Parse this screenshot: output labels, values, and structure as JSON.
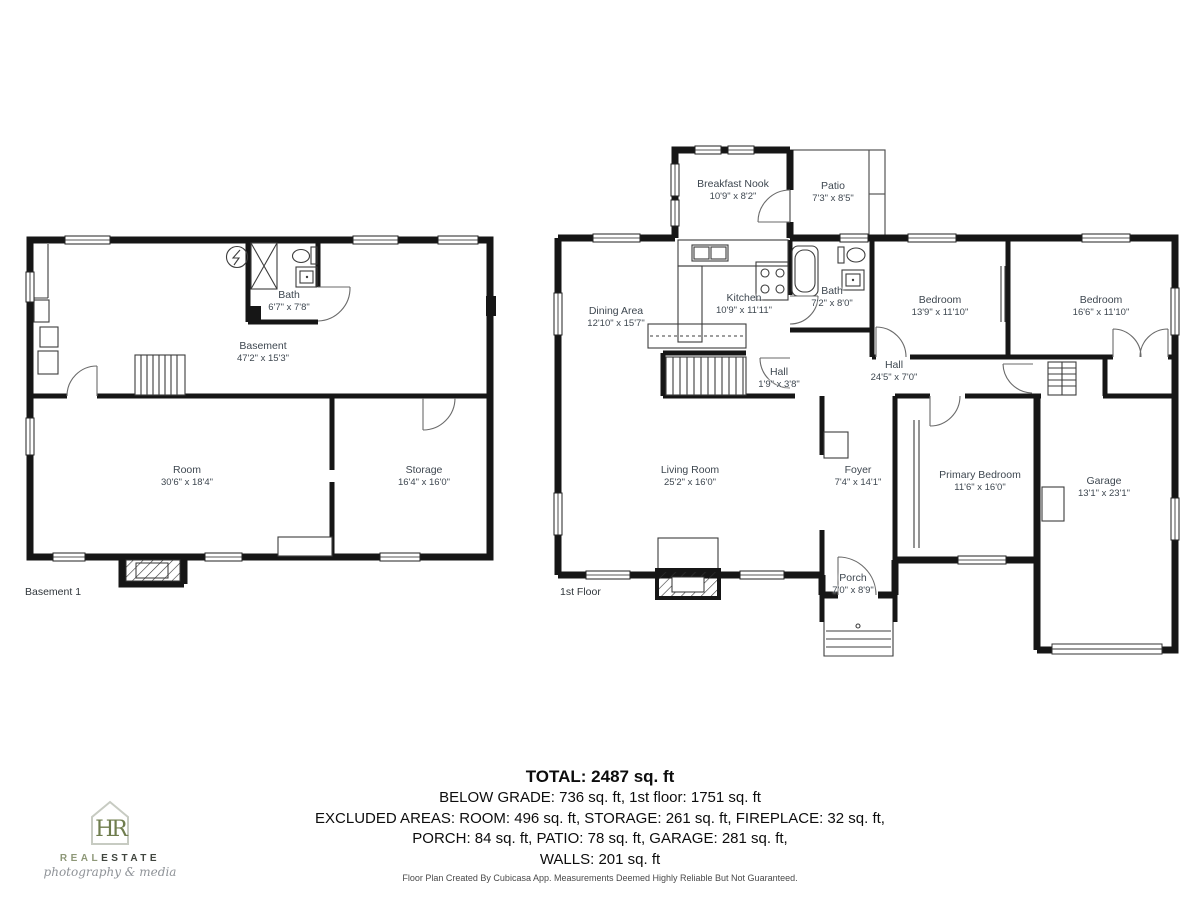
{
  "floors": {
    "basement": {
      "label": "Basement 1",
      "rooms": {
        "bath": {
          "name": "Bath",
          "dims": "6'7\" x 7'8\""
        },
        "basement": {
          "name": "Basement",
          "dims": "47'2\" x 15'3\""
        },
        "room": {
          "name": "Room",
          "dims": "30'6\" x 18'4\""
        },
        "storage": {
          "name": "Storage",
          "dims": "16'4\" x 16'0\""
        }
      }
    },
    "first": {
      "label": "1st Floor",
      "rooms": {
        "breakfast_nook": {
          "name": "Breakfast Nook",
          "dims": "10'9\" x 8'2\""
        },
        "patio": {
          "name": "Patio",
          "dims": "7'3\" x 8'5\""
        },
        "dining": {
          "name": "Dining Area",
          "dims": "12'10\" x 15'7\""
        },
        "kitchen": {
          "name": "Kitchen",
          "dims": "10'9\" x 11'11\""
        },
        "bath": {
          "name": "Bath",
          "dims": "7'2\" x 8'0\""
        },
        "bedroom1": {
          "name": "Bedroom",
          "dims": "13'9\" x 11'10\""
        },
        "bedroom2": {
          "name": "Bedroom",
          "dims": "16'6\" x 11'10\""
        },
        "hall_small": {
          "name": "Hall",
          "dims": "1'9\" x 3'8\""
        },
        "hall": {
          "name": "Hall",
          "dims": "24'5\" x 7'0\""
        },
        "living": {
          "name": "Living Room",
          "dims": "25'2\" x 16'0\""
        },
        "foyer": {
          "name": "Foyer",
          "dims": "7'4\" x 14'1\""
        },
        "primary": {
          "name": "Primary Bedroom",
          "dims": "11'6\" x 16'0\""
        },
        "garage": {
          "name": "Garage",
          "dims": "13'1\" x 23'1\""
        },
        "porch": {
          "name": "Porch",
          "dims": "7'0\" x 8'9\""
        }
      }
    }
  },
  "summary": {
    "total": "TOTAL: 2487 sq. ft",
    "below_grade": "BELOW GRADE: 736 sq. ft, 1st floor: 1751 sq. ft",
    "excluded": "EXCLUDED AREAS: ROOM: 496 sq. ft, STORAGE: 261 sq. ft, FIREPLACE: 32 sq. ft,",
    "excluded2": "PORCH: 84 sq. ft, PATIO: 78 sq. ft, GARAGE: 281 sq. ft,",
    "walls": "WALLS: 201 sq. ft"
  },
  "footer": "Floor Plan Created By Cubicasa App. Measurements Deemed Highly Reliable But Not Guaranteed.",
  "logo": {
    "monogram": "HR",
    "word1": "REAL",
    "word2": "ESTATE",
    "tagline": "photography & media",
    "green": "#6f7d4e"
  }
}
